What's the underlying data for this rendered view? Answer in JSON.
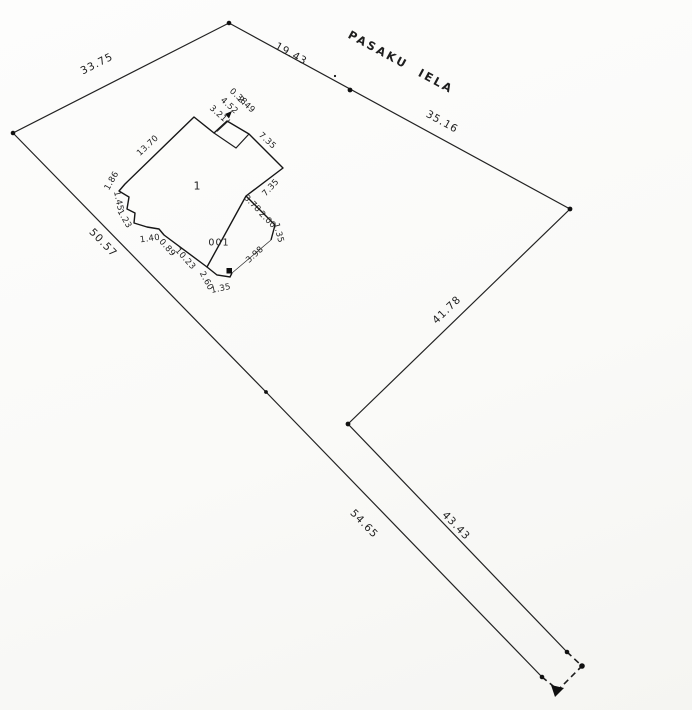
{
  "plan": {
    "type": "cadastral survey plan",
    "street_name": "PASAKU IELA",
    "parcel": {
      "edge_lengths_m": [
        "33.75",
        "19.43",
        "35.16",
        "41.78",
        "43.43",
        "54.65",
        "50.57"
      ]
    },
    "building": {
      "number": "1",
      "code": "001",
      "dimensions_m": [
        "13.70",
        "1.86",
        "1.45",
        "1.23",
        "1.40",
        "0.89",
        "10.23",
        "3.21",
        "4.52",
        "0.38",
        "2.49",
        "7.35",
        "7.35",
        "3.78",
        "2.00",
        "1.35",
        "3.98",
        "2.60",
        "1.35"
      ]
    },
    "markers": [
      "survey-point-dots",
      "black-square-marker",
      "solid-triangle-markers",
      "dashed-corner"
    ]
  },
  "labels": [
    {
      "name": "edge-length-33-75",
      "text": "33.75",
      "x": 97,
      "y": 64,
      "rot": -27,
      "cls": "parcel"
    },
    {
      "name": "edge-length-19-43",
      "text": "19.43",
      "x": 291,
      "y": 54,
      "rot": 29,
      "cls": "parcel"
    },
    {
      "name": "street-name",
      "text": "PASAKU IELA",
      "x": 401,
      "y": 62,
      "rot": 28.5,
      "cls": "street"
    },
    {
      "name": "edge-length-35-16",
      "text": "35.16",
      "x": 442,
      "y": 122,
      "rot": 29,
      "cls": "parcel"
    },
    {
      "name": "edge-length-41-78",
      "text": "41.78",
      "x": 447,
      "y": 310,
      "rot": -44,
      "cls": "parcel"
    },
    {
      "name": "edge-length-50-57",
      "text": "50.57",
      "x": 103,
      "y": 243,
      "rot": 46,
      "cls": "parcel"
    },
    {
      "name": "edge-length-54-65",
      "text": "54.65",
      "x": 364,
      "y": 524,
      "rot": 46,
      "cls": "parcel"
    },
    {
      "name": "edge-length-43-43",
      "text": "43.43",
      "x": 456,
      "y": 526,
      "rot": 46,
      "cls": "parcel"
    },
    {
      "name": "building-dim-13-70",
      "text": "13.70",
      "x": 148,
      "y": 146,
      "rot": -43,
      "cls": "dim"
    },
    {
      "name": "building-dim-1-86",
      "text": "1.86",
      "x": 112,
      "y": 181,
      "rot": -60,
      "cls": "dim"
    },
    {
      "name": "building-dim-1-45",
      "text": "1.45",
      "x": 118,
      "y": 201,
      "rot": 78,
      "cls": "dim"
    },
    {
      "name": "building-dim-1-23",
      "text": "1.23",
      "x": 124,
      "y": 219,
      "rot": 60,
      "cls": "dim"
    },
    {
      "name": "building-dim-1-40",
      "text": "1.40",
      "x": 150,
      "y": 239,
      "rot": -8,
      "cls": "dim"
    },
    {
      "name": "building-dim-0-89",
      "text": "0.89",
      "x": 167,
      "y": 248,
      "rot": 48,
      "cls": "dim"
    },
    {
      "name": "building-dim-10-23",
      "text": "10.23",
      "x": 185,
      "y": 259,
      "rot": 48,
      "cls": "dim"
    },
    {
      "name": "building-number",
      "text": "1",
      "x": 197,
      "y": 186,
      "rot": 0,
      "cls": "bnum"
    },
    {
      "name": "building-code",
      "text": "001",
      "x": 219,
      "y": 243,
      "rot": 0,
      "cls": "bcode"
    },
    {
      "name": "building-dim-3-21",
      "text": "3.21",
      "x": 218,
      "y": 114,
      "rot": 42,
      "cls": "dim"
    },
    {
      "name": "building-dim-4-52",
      "text": "4.52",
      "x": 229,
      "y": 106,
      "rot": 42,
      "cls": "dim"
    },
    {
      "name": "building-dim-0-38",
      "text": "0.38",
      "x": 238,
      "y": 97,
      "rot": 42,
      "cls": "dim"
    },
    {
      "name": "building-dim-2-49",
      "text": "2.49",
      "x": 246,
      "y": 105,
      "rot": 42,
      "cls": "dim"
    },
    {
      "name": "building-dim-7-35-street",
      "text": "7.35",
      "x": 267,
      "y": 141,
      "rot": 43,
      "cls": "dim"
    },
    {
      "name": "building-dim-7-35-east",
      "text": "7.35",
      "x": 271,
      "y": 188,
      "rot": -47,
      "cls": "dim"
    },
    {
      "name": "building-dim-3-78",
      "text": "3.78",
      "x": 252,
      "y": 204,
      "rot": 45,
      "cls": "dim"
    },
    {
      "name": "building-dim-2-00",
      "text": "2.00",
      "x": 267,
      "y": 220,
      "rot": 45,
      "cls": "dim"
    },
    {
      "name": "building-dim-1-35-east",
      "text": "1.35",
      "x": 278,
      "y": 233,
      "rot": 75,
      "cls": "dim"
    },
    {
      "name": "building-dim-3-98",
      "text": "3.98",
      "x": 255,
      "y": 255,
      "rot": -42,
      "cls": "dim"
    },
    {
      "name": "building-dim-2-60",
      "text": "2.60",
      "x": 206,
      "y": 281,
      "rot": 62,
      "cls": "dim"
    },
    {
      "name": "building-dim-1-35-south",
      "text": "1.35",
      "x": 221,
      "y": 289,
      "rot": -12,
      "cls": "dim"
    }
  ]
}
